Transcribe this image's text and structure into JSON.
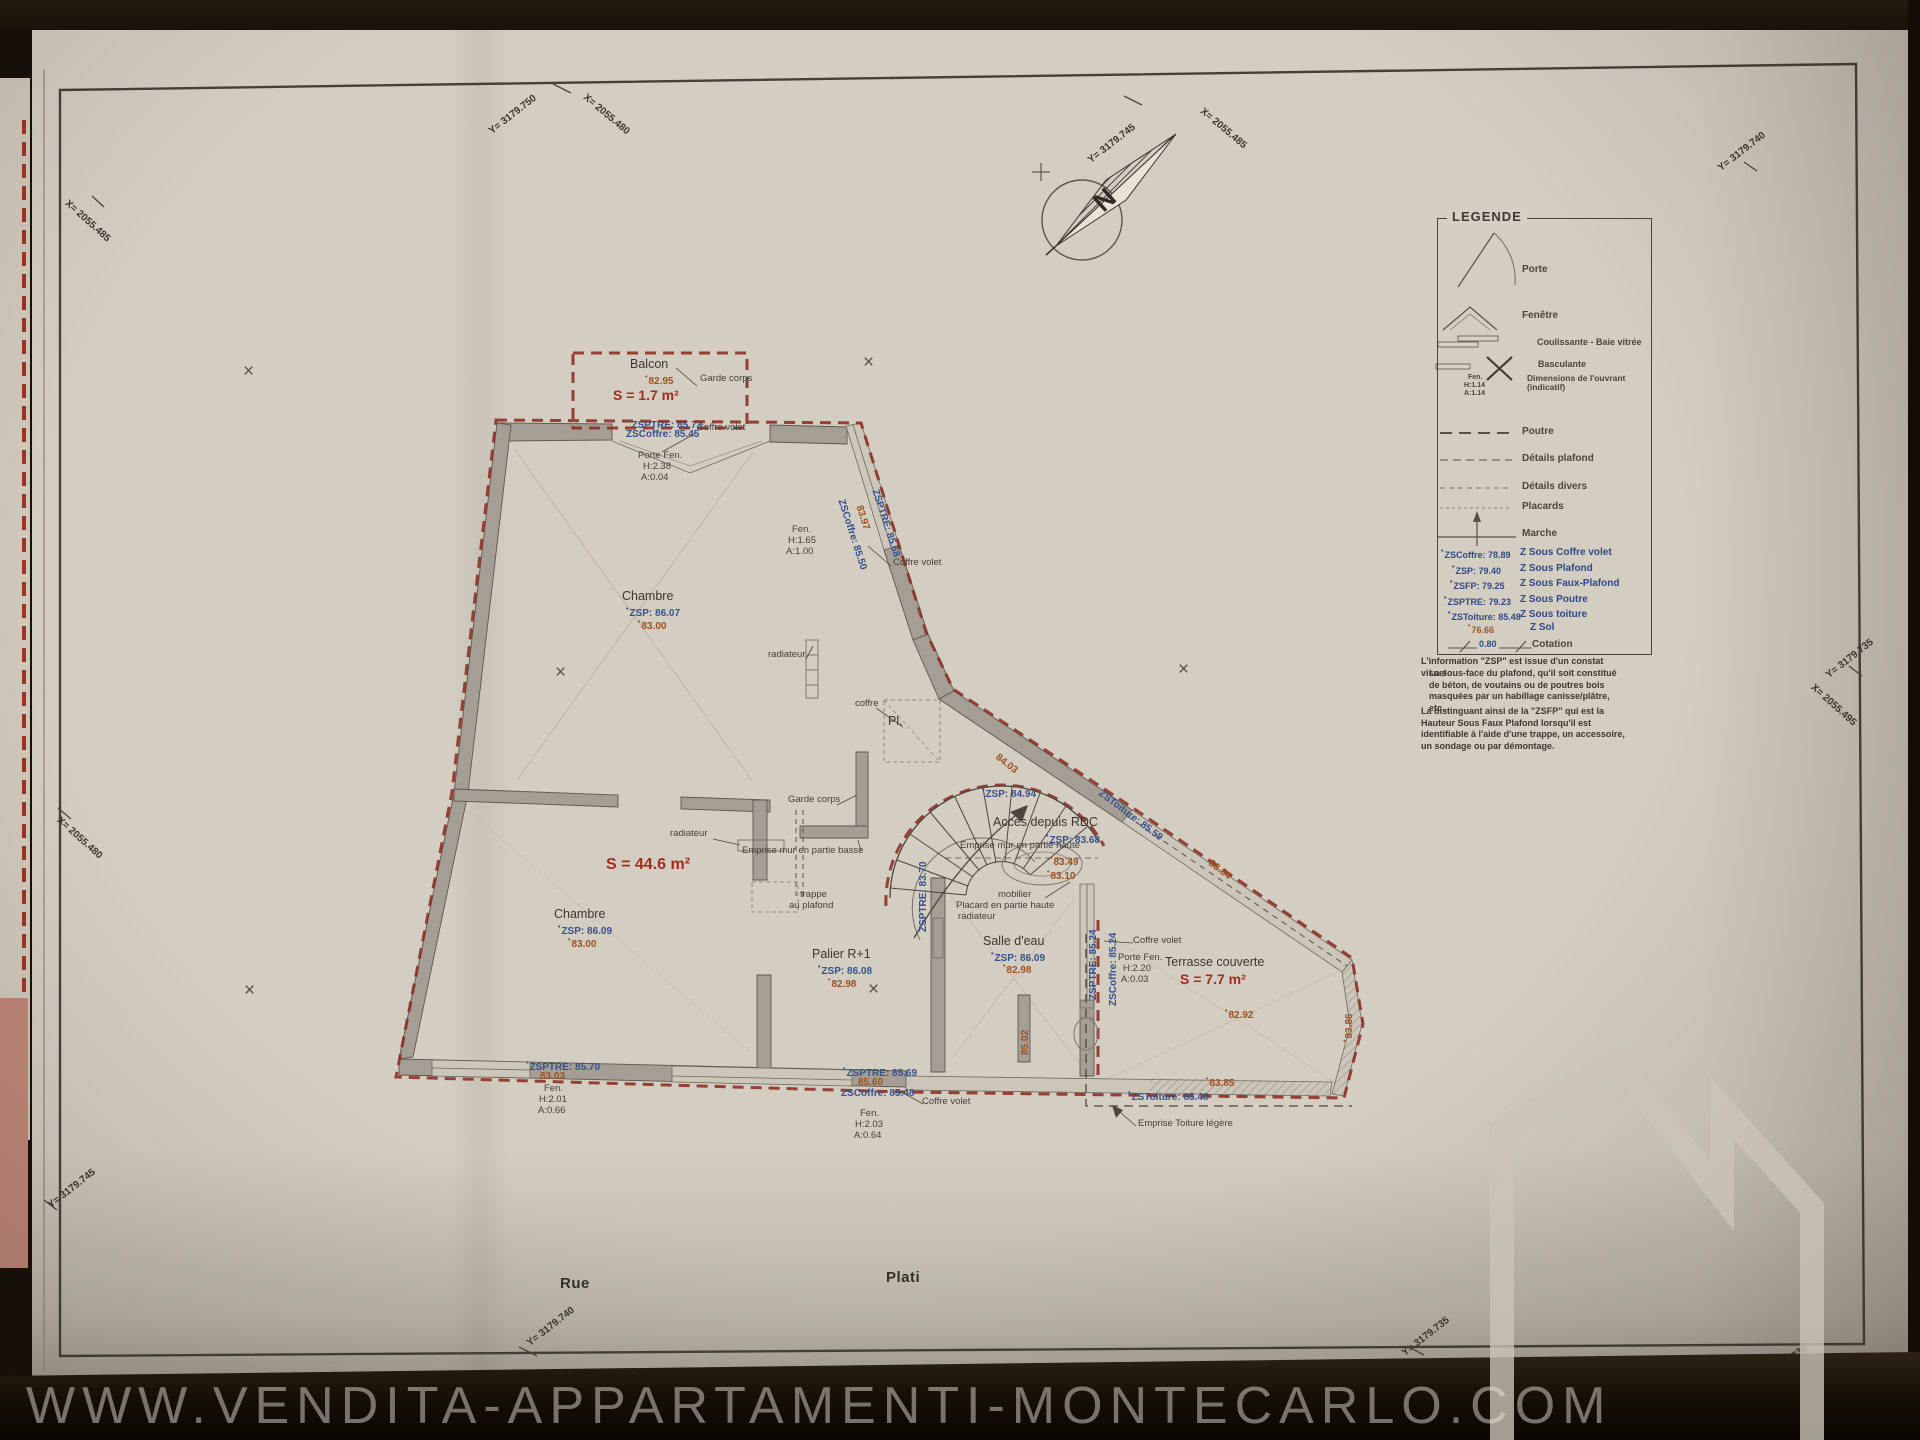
{
  "photo": {
    "watermark_url": "WWW.VENDITA-APPARTAMENTI-MONTECARLO.COM"
  },
  "north_arrow": {
    "letter": "N"
  },
  "streets": {
    "rue": "Rue",
    "plati": "Plati"
  },
  "geo_labels": {
    "left_top_x": "X= 2055.485",
    "top1_y": "Y= 3179.750",
    "top1_x": "X= 2055.480",
    "top2_y": "Y= 3179.745",
    "top2_x": "X= 2055.485",
    "top_right_y": "Y= 3179.740",
    "left_mid_x": "X= 2055.480",
    "left_bottom_y": "Y= 3179.745",
    "right_y": "Y= 3179.735",
    "right_x": "X= 2055.495",
    "bottom_left_y": "Y= 3179.740",
    "bottom_mid_y": "Y= 3179.735",
    "bottom_right_y": "Y= 3179.730"
  },
  "legend": {
    "title": "LEGENDE",
    "items": [
      {
        "id": "porte",
        "label": "Porte"
      },
      {
        "id": "fenetre",
        "label": "Fenêtre"
      },
      {
        "id": "coulissante",
        "label": "Coulissante - Baie vitrée"
      },
      {
        "id": "basculante",
        "label": "Basculante"
      },
      {
        "id": "dimensions",
        "label": "Dimensions de l'ouvrant (indicatif)",
        "sample": [
          "Fen.",
          "H:1.14",
          "A:1.14"
        ]
      },
      {
        "id": "poutre",
        "label": "Poutre"
      },
      {
        "id": "details-plafond",
        "label": "Détails plafond"
      },
      {
        "id": "details-divers",
        "label": "Détails divers"
      },
      {
        "id": "placards",
        "label": "Placards"
      },
      {
        "id": "marche",
        "label": "Marche"
      },
      {
        "id": "z-sous-coffre",
        "key": "ZSCoffre: 78.89",
        "label": "Z Sous Coffre volet"
      },
      {
        "id": "z-sous-plafond",
        "key": "ZSP: 79.40",
        "label": "Z Sous Plafond"
      },
      {
        "id": "z-sous-faux-plafond",
        "key": "ZSFP: 79.25",
        "label": "Z Sous Faux-Plafond"
      },
      {
        "id": "z-sous-poutre",
        "key": "ZSPTRE: 79.23",
        "label": "Z Sous Poutre"
      },
      {
        "id": "z-sous-toiture",
        "key": "ZSToiture: 85.48",
        "label": "Z Sous toiture"
      },
      {
        "id": "z-sol",
        "key": "76.66",
        "label": "Z Sol"
      },
      {
        "id": "cotation",
        "key": "0.80",
        "label": "Cotation"
      }
    ],
    "note": {
      "line1": "L'information \"ZSP\" est issue d'un constat visuel :",
      "line2": "La sous-face du plafond, qu'il soit constitué de béton, de voutains ou de poutres bois masquées par un habillage canisse/plâtre, etc...",
      "line3": "La distinguant ainsi de la \"ZSFP\" qui est la Hauteur Sous Faux Plafond lorsqu'il est identifiable à l'aide d'une trappe, un accessoire, un sondage ou par démontage."
    }
  },
  "plan": {
    "balcon_title": "Balcon",
    "balcon_sol": "82.95",
    "balcon_area": "S = 1.7 m²",
    "garde_corps_top": "Garde corps",
    "coffre_volet_top": "Coffre volet",
    "balcon_zsptre": "ZSPTRE: 85.73",
    "balcon_zscoffre": "ZSCoffre: 85.45",
    "porte_fen_top": "Porte Fen.",
    "porte_fen_top_h": "H:2.38",
    "porte_fen_top_a": "A:0.04",
    "chambre1_title": "Chambre",
    "chambre1_zsp": "ZSP: 86.07",
    "chambre1_sol": "83.00",
    "radiateur_1": "radiateur",
    "radiateur_2": "radiateur",
    "radiateur_3": "radiateur",
    "fen_right": "Fen.",
    "fen_right_h": "H:1.65",
    "fen_right_a": "A:1.00",
    "slant_zsptre": "ZSPTRE: 85.68",
    "slant_sol": "83.97",
    "slant_zscoffre": "ZSCoffre: 85.50",
    "coffre_volet_right": "Coffre volet",
    "coffre_label": "coffre",
    "placard_abbr": "Pl.",
    "garde_corps_mid": "Garde corps",
    "emprise_mur_basse": "Emprise mur en partie basse",
    "trappe_line1": "trappe",
    "trappe_line2": "au plafond",
    "sejour_area": "S = 44.6 m²",
    "chambre2_title": "Chambre",
    "chambre2_zsp": "ZSP: 86.09",
    "chambre2_sol": "83.00",
    "stairs_zsp": "ZSP: 84.94",
    "stairs_diag_sol": "84.03",
    "acces_rdc": "Accès depuis RDC",
    "acces_zsp": "ZSP: 83.68",
    "emprise_mur_haute": "Emprise mur en partie haute",
    "sol_83_49": "83.49",
    "sol_83_10": "83.10",
    "mobilier": "mobilier",
    "placard_haute": "Placard en partie haute",
    "zsptre_83_70": "ZSPTRE: 83.70",
    "palier_title": "Palier R+1",
    "palier_zsp": "ZSP: 86.08",
    "palier_sol": "82.98",
    "salle_eau_title": "Salle d'eau",
    "salle_eau_zsp": "ZSP: 86.09",
    "salle_eau_sol": "82.98",
    "wall_sol_85_02": "85.02",
    "toiture_diag_zs": "ZSToiture: 85.59",
    "toiture_diag_sol": "83.84",
    "terr_coffre_volet": "Coffre volet",
    "terr_porte_fen": "Porte Fen.",
    "terr_porte_h": "H:2.20",
    "terr_porte_a": "A:0.03",
    "terrasse_title": "Terrasse couverte",
    "terrasse_area": "S = 7.7 m²",
    "terrasse_sol": "82.92",
    "terr_right_sol": "83.86",
    "terr_bottom_sol": "83.85",
    "terr_zstoiture": "ZSToiture: 85.48",
    "emprise_toiture": "Emprise Toiture légère",
    "zsptre_85_24": "ZSPTRE: 85.24",
    "zscoffre_85_24": "ZSCoffre: 85.24",
    "bot_zsptre": "ZSPTRE: 85.69",
    "bot_sol": "85.60",
    "bot_zscoffre": "ZSCoffre: 85.48",
    "bot_coffre_volet": "Coffre volet",
    "bot_fen": "Fen.",
    "bot_fen_h": "H:2.03",
    "bot_fen_a": "A:0.64",
    "botleft_zsptre": "ZSPTRE: 85.70",
    "botleft_sol": "83.03",
    "botleft_fen": "Fen.",
    "botleft_fen_h": "H:2.01",
    "botleft_fen_a": "A:0.66"
  }
}
